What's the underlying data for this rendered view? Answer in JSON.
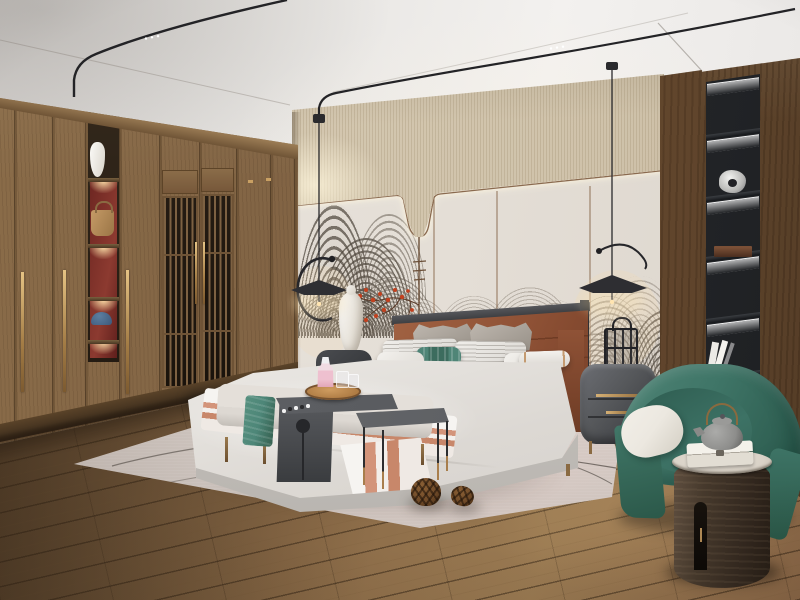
{
  "meta": {
    "type": "natural-image",
    "subject": "Photorealistic rendering of a modern new-Chinese-style bedroom",
    "width_px": 800,
    "height_px": 600,
    "visible_text": ""
  },
  "scene": {
    "ceiling": {
      "label": "white tray ceiling with two black magnetic track lights with LED dots"
    },
    "pendant_lamps": {
      "label": "two minimalist black disc pendant lamps with curved wire arms and warm glow"
    },
    "back_wall": {
      "upper_band": "textured beige wallpaper band with cove lighting",
      "panels": "light warm-gray wall panels with thin backlit bronze trim, U-shaped dip detail and hanging rod",
      "mural": "gray concentric-line wave/mountain mural (new Chinese style)",
      "accent": "red plum-blossom branch decoration"
    },
    "wardrobe": {
      "label": "floor-to-ceiling walnut wardrobe",
      "features": [
        "long brass bar handles",
        "two lattice-slat doors with transoms",
        "lit open display column"
      ],
      "display_items": [
        "white ceramic vase",
        "tan leather handbag",
        "blue cap",
        "red back panels"
      ]
    },
    "right_wall": {
      "label": "dark walnut accent wall with recessed black display niche",
      "niche_items": [
        "silver abstract sculpture",
        "dark wooden box",
        "leaning white books"
      ],
      "lighting": "LED strip under each shelf"
    },
    "floor": {
      "label": "rustic brown oak plank floor laid diagonally"
    },
    "rug": {
      "label": "large light greige area rug with thin dark curved line pattern",
      "decor": [
        "two pinecones"
      ]
    },
    "bed": {
      "headboard": "cognac leather panel headboard with dark metal frame",
      "pillows": [
        "two gray peaked pillows",
        "two white pinstripe pillows",
        "teal patterned lumbar pillow",
        "white pillows",
        "white bolster with tan stripes"
      ],
      "bedding": "white duvet with terracotta-striped throw runner",
      "base": "light gray upholstered platform"
    },
    "bench_group": {
      "bench": "light gray upholstered bench with bronze legs and teal throw",
      "c_table": "dark gray waterfall side table with circular cutout",
      "tray": "round wooden tray with pink perfume bottle and two glasses",
      "side_table": "dark gray rectangular side table with thin brass-tipped legs"
    },
    "nightstands": {
      "left": "dark round nightstand with tall white gourd ceramic lamp",
      "right": "gray rounded two-drawer nightstand with brass handle, black lantern object on top"
    },
    "seating": {
      "armchair": "teal-green barrel armchair with white seat cushion",
      "drum_table": "dark wood cylinder drum table with marble top, gray teapot with brass handle and white gift box"
    }
  },
  "palette": {
    "ceiling_light": "#f2f0ee",
    "wall_beige": "#d8ccb5",
    "cove_glow": "#fdf2d6",
    "panel": "#e9e4dd",
    "trim_bronze": "#8a6a4f",
    "art_gray": "#6e665c",
    "accent_red": "#c2401e",
    "wood": "#8a6c49",
    "wood_dark": "#6b5134",
    "wood_right": "#74563a",
    "niche_bg": "#26282b",
    "led_white": "#ffffff",
    "floor": "#8a6a47",
    "floor_dark": "#4a3724",
    "rug": "#d9d0ca",
    "leather": "#a06142",
    "leather_dark": "#7e452c",
    "frame_dark": "#3c3d40",
    "duvet": "#efede9",
    "throw_terracotta": "#d3947a",
    "pillow_gray": "#b3aca4",
    "pillow_teal": "#4f8577",
    "bench_fabric": "#ddd8d2",
    "throw_teal": "#4d8678",
    "furn_gray": "#55575a",
    "brass": "#c29d66",
    "chair_teal": "#3f7567",
    "cushion_white": "#ece8e0",
    "cylinder_wood": "#46392c",
    "marble": "#d9d2c7",
    "teapot_gray": "#8d8d8b",
    "track_black": "#232326",
    "vase_white": "#f6f4f0",
    "bag_tan": "#b98d5c",
    "cap_blue": "#47678a",
    "shelf_back_red": "#7c2b26",
    "pine_brown": "#6f4a28",
    "lamp_warm": "#f7dcab"
  }
}
